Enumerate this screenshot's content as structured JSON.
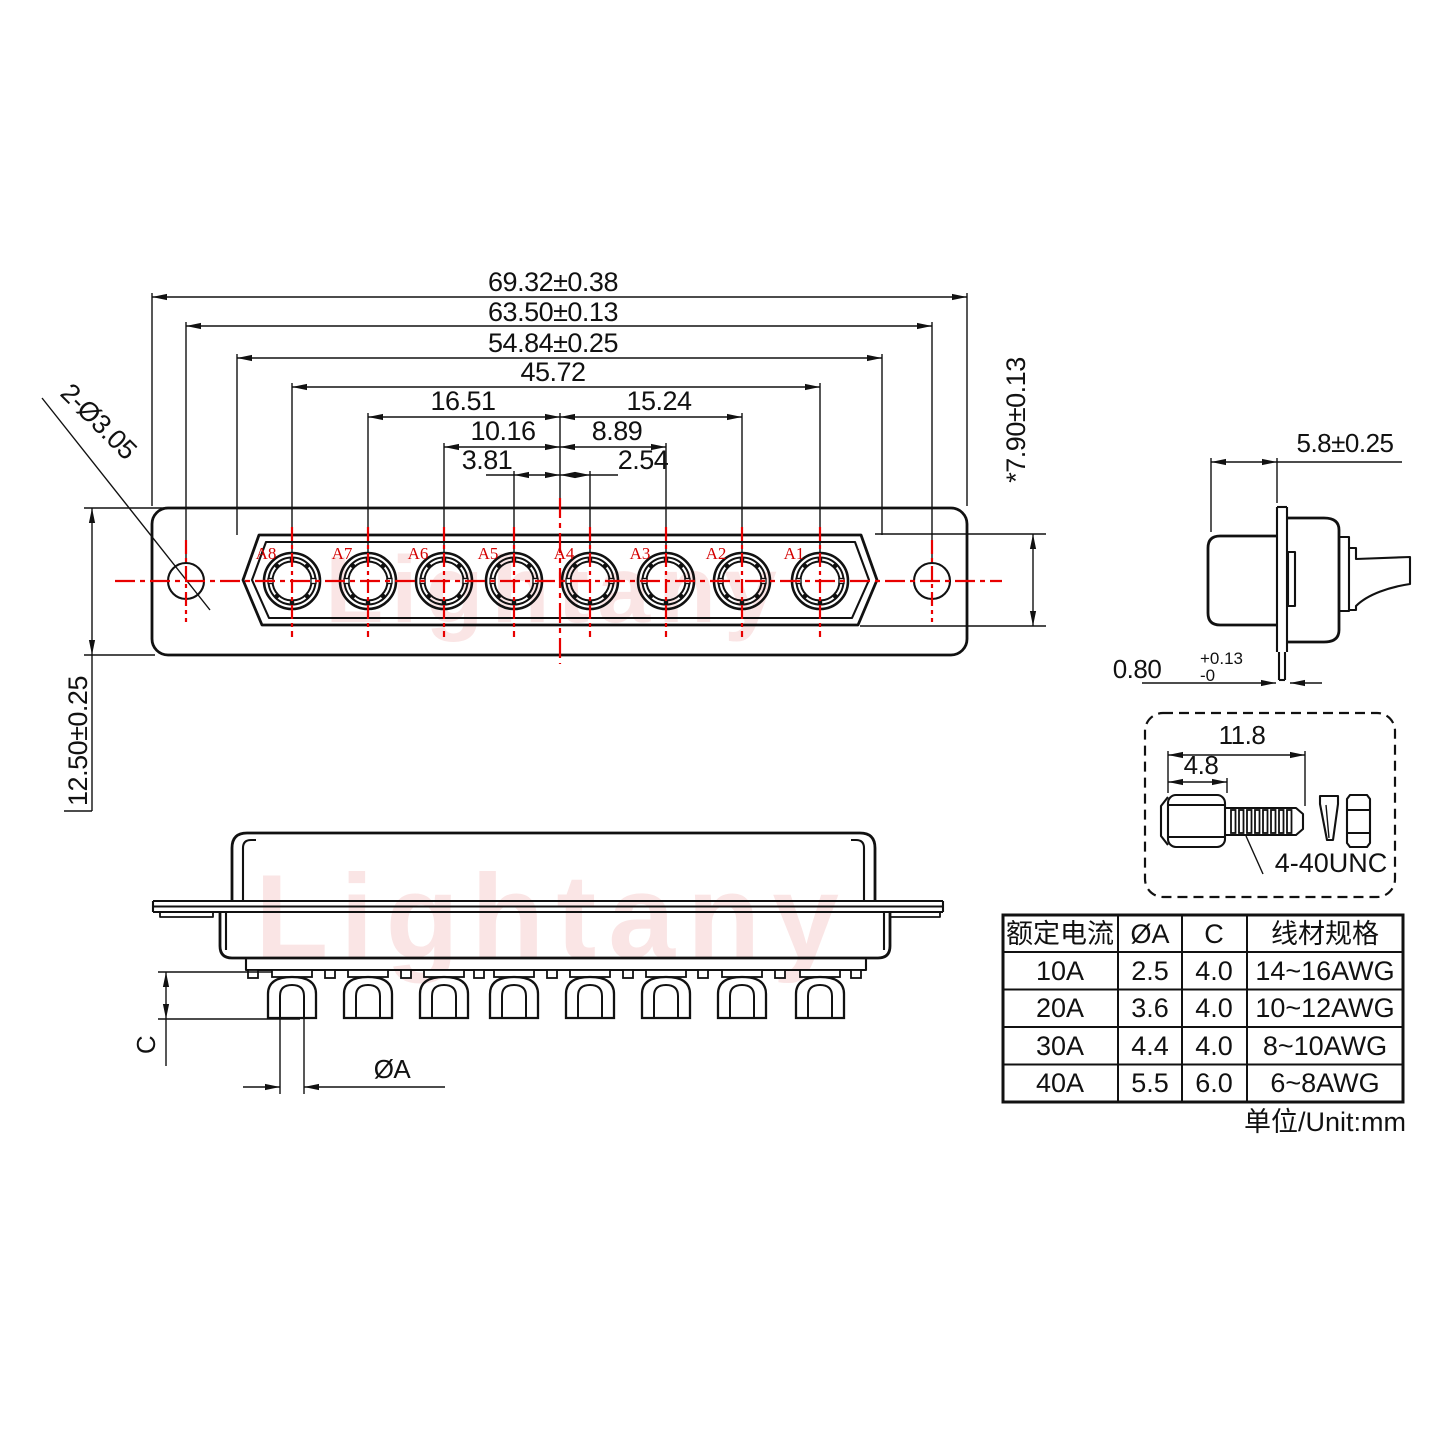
{
  "watermark": {
    "text": "Lightany"
  },
  "front_view": {
    "contact_labels": [
      "A8",
      "A7",
      "A6",
      "A5",
      "A4",
      "A3",
      "A2",
      "A1"
    ],
    "dims": {
      "width_outer": "69.32±0.38",
      "width_holes": "63.50±0.13",
      "width_insert": "54.84±0.25",
      "width_contacts": "45.72",
      "left_a7": "16.51",
      "right_a2": "15.24",
      "left_a6": "10.16",
      "right_a3": "8.89",
      "left_a5": "3.81",
      "right_a4": "2.54",
      "insert_height": "*7.90±0.13",
      "body_height": "12.50±0.25",
      "hole_note": "2-Ø3.05"
    }
  },
  "side_view": {
    "dims": {
      "face_to_flange": "5.8±0.25",
      "flange_thickness": "0.80",
      "flange_tol_upper": "+0.13",
      "flange_tol_lower": "-0"
    }
  },
  "bottom_view": {
    "dims": {
      "cup_depth": "C",
      "cup_diameter": "ØA"
    }
  },
  "screw_detail": {
    "dims": {
      "overall_length": "11.8",
      "head_length": "4.8"
    },
    "thread_label": "4-40UNC"
  },
  "spec_table": {
    "headers": [
      "额定电流",
      "ØA",
      "C",
      "线材规格"
    ],
    "rows": [
      [
        "10A",
        "2.5",
        "4.0",
        "14~16AWG"
      ],
      [
        "20A",
        "3.6",
        "4.0",
        "10~12AWG"
      ],
      [
        "30A",
        "4.4",
        "4.0",
        "8~10AWG"
      ],
      [
        "40A",
        "5.5",
        "6.0",
        "6~8AWG"
      ]
    ]
  },
  "unit_note": "单位/Unit:mm"
}
